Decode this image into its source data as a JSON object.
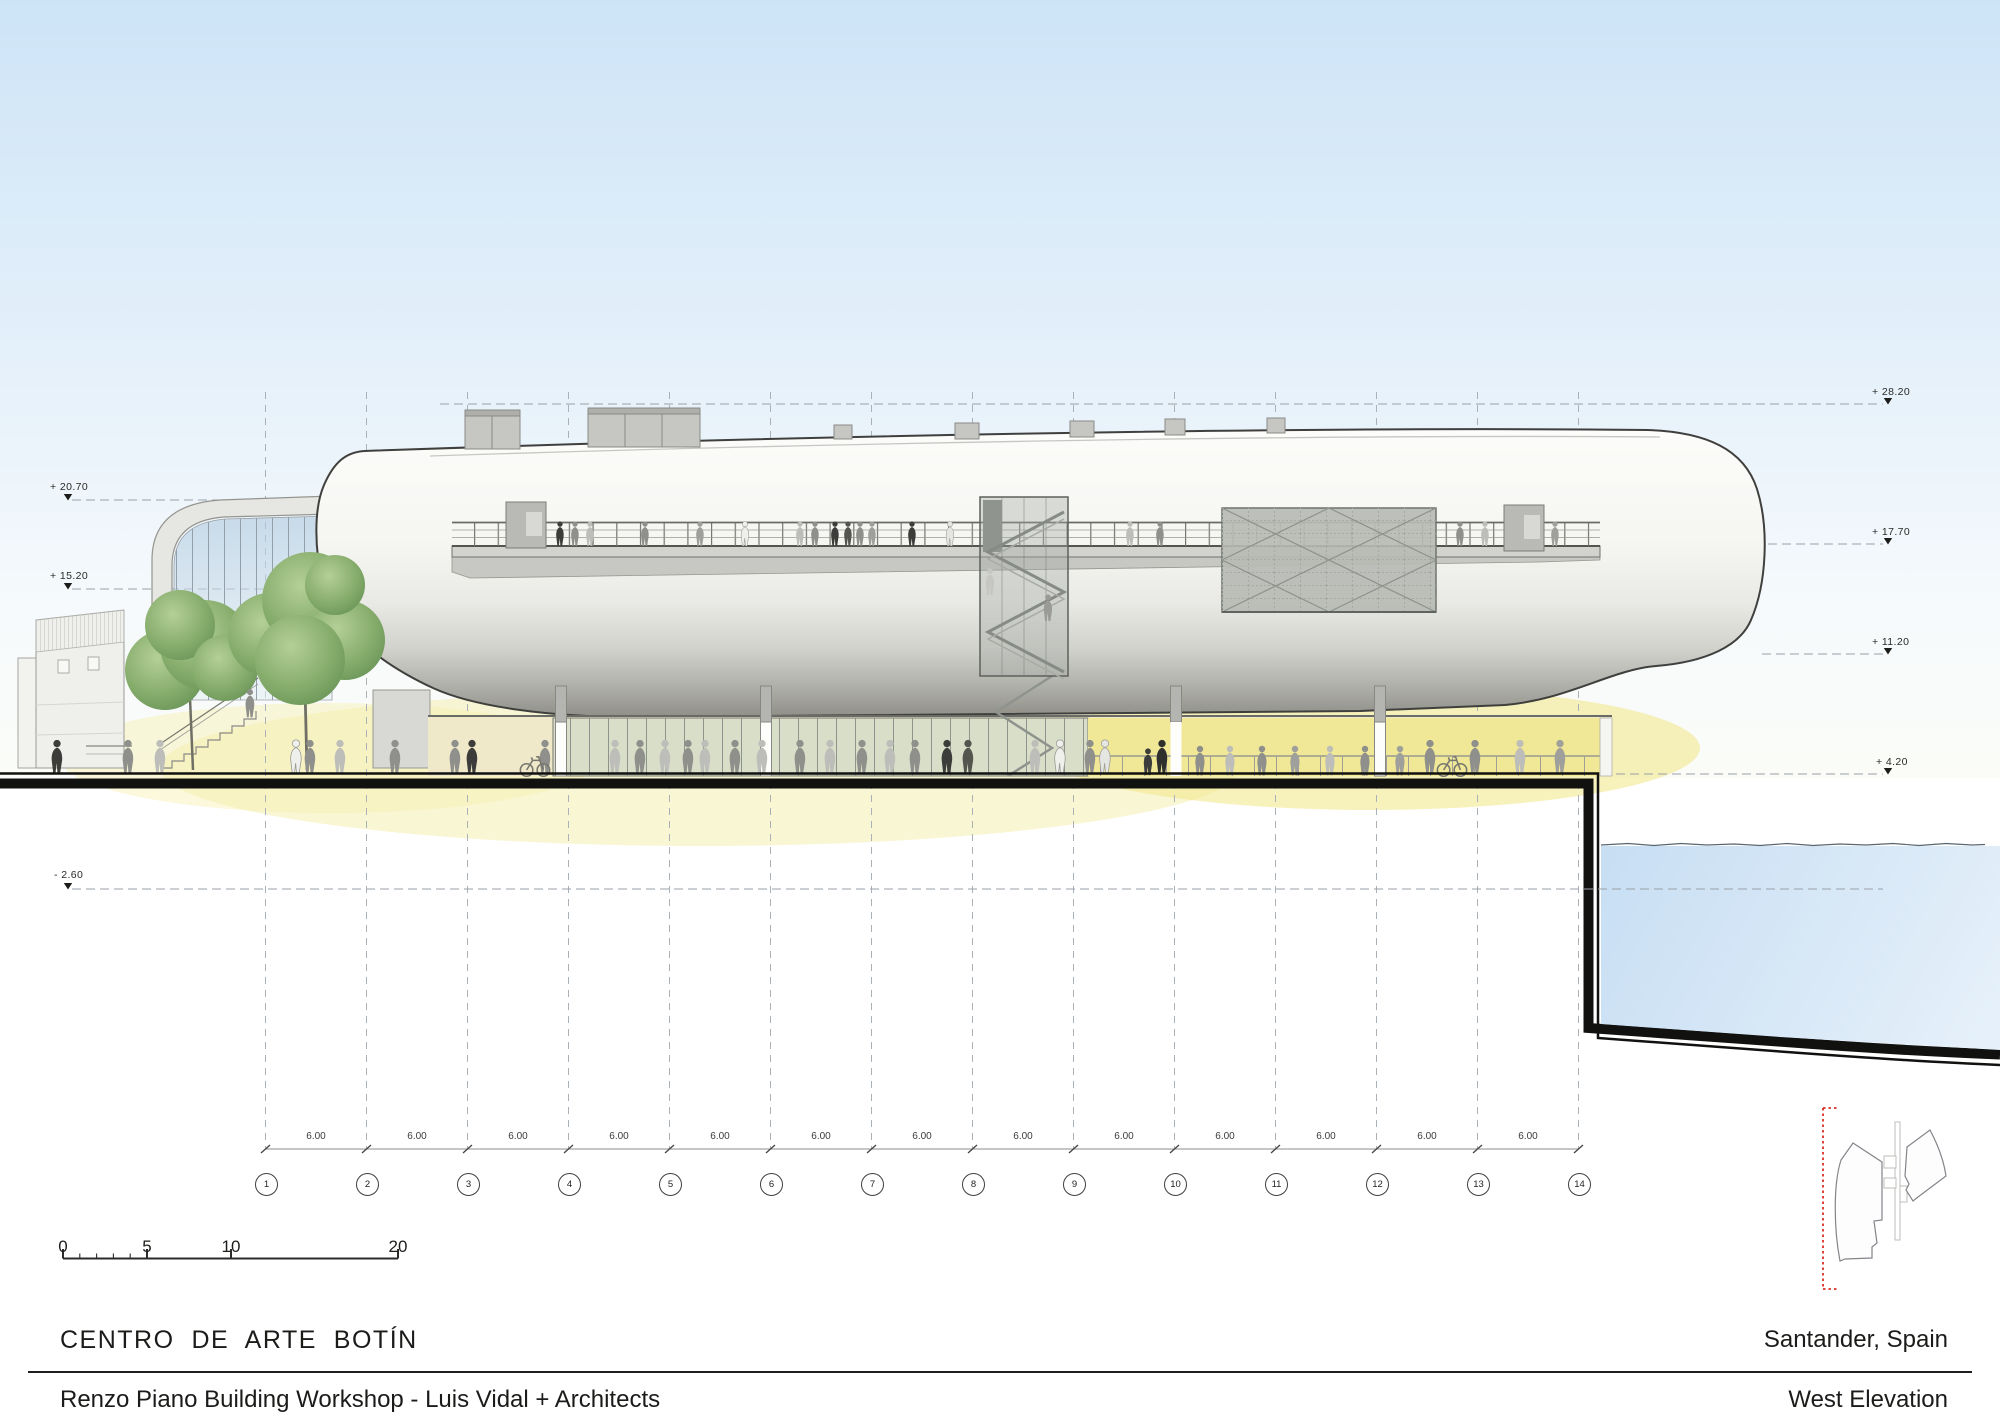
{
  "titles": {
    "project": "CENTRO  DE  ARTE  BOTÍN",
    "architects": "Renzo Piano Building Workshop - Luis Vidal + Architects",
    "location": "Santander, Spain",
    "drawing": "West Elevation"
  },
  "levels": {
    "left": [
      {
        "label": "+ 20.70"
      },
      {
        "label": "+ 15.20"
      },
      {
        "label": "- 2.60"
      }
    ],
    "right": [
      {
        "label": "+ 28.20"
      },
      {
        "label": "+ 17.70"
      },
      {
        "label": "+ 11.20"
      },
      {
        "label": "+ 4.20"
      }
    ]
  },
  "grid": {
    "bubbles": [
      "1",
      "2",
      "3",
      "4",
      "5",
      "6",
      "7",
      "8",
      "9",
      "10",
      "11",
      "12",
      "13",
      "14"
    ],
    "spacing_label": "6.00"
  },
  "scale_bar": {
    "labels": [
      "0",
      "5",
      "10",
      "20"
    ]
  },
  "colors": {
    "sky_top": "#cde4f7",
    "sky_bottom": "#fbfcf8",
    "water": "#cfe3f5",
    "interior_glow": "#f1ea96",
    "tree_green": "#7ba567",
    "ink": "#1d1d1b",
    "grid_gray": "#9aa0a8",
    "section_red": "#d93025"
  }
}
